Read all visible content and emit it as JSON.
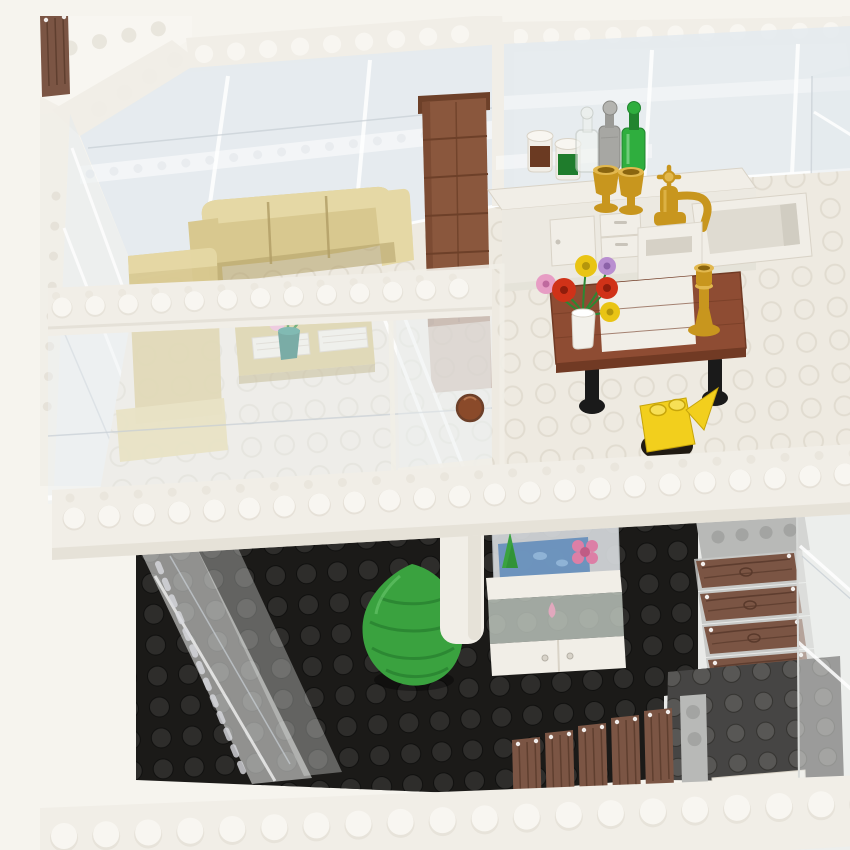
{
  "image": {
    "caption": "Photograph of a two-story LEGO modular house with transparent glass walls viewed from an elevated angle: upper floor with tan sofa and armchair, brown brick chimney, white kitchen counter holding jars, bottles, gold goblets and a gold faucet sink, a brown dining table with a white runner, flower vase, gold candlestick and yellow watering can; ground floor with black studded baseplate, green leaf tree, white column, aquarium cabinet and a wooden staircase."
  },
  "palette": {
    "bg": "#f6f4ee",
    "white_hi": "#f8f6f1",
    "white_plastic": "#f1eee7",
    "white_shade": "#e3dfd5",
    "stud_line": "#d9d3c7",
    "glass": "#e4eaee",
    "glass_line": "#c8cfd5",
    "floor": "#eeeae1",
    "floor_stud": "#ded8cc",
    "black_plate": "#1b1a18",
    "black_stud": "#2e2d2b",
    "dark_gray": "#464544",
    "dark_gray_stud": "#585755",
    "light_gray": "#b8b9b7",
    "light_gray_stud": "#a3a4a2",
    "tan": "#d8c88f",
    "tan_dark": "#b3a068",
    "tan_light": "#e5d8a5",
    "brown": "#8a573d",
    "brown_dark": "#6d4029",
    "table_brown": "#8e4c33",
    "table_dark": "#713a24",
    "wood": "#7b5544",
    "wood_dark": "#59392b",
    "gold": "#c8961e",
    "gold_light": "#e2b84e",
    "bottle_green": "#2fae3e",
    "bottle_green_dark": "#22842f",
    "bottle_grey": "#a7a7a3",
    "jar_brown": "#6b3a22",
    "jar_green": "#1f7c2c",
    "tree_green": "#3aa23f",
    "tree_dark": "#2c8833",
    "flower_red": "#d03218",
    "flower_yellow": "#e9c414",
    "flower_pink": "#e79dc4",
    "flower_lavender": "#b98fd0",
    "flower_purple": "#9b6cc0",
    "flower_white": "#ffffff",
    "vase_teal": "#2e7d72",
    "aqua_blue": "#5d89ba",
    "aqua_pink": "#dc7fa6",
    "door_knob": "#8a4a2a",
    "can_yellow": "#f2cf1d",
    "pot_black": "#201a12"
  },
  "scene": {
    "setting": "Two-story LEGO house with transparent wall panels and white studded plate framing, elevated three-quarter view",
    "upper_floor": {
      "floor": "white studded plates",
      "objects": [
        "tan sofa",
        "tan armchair",
        "tan coffee bench with white grilles",
        "bouquet of white, pink and purple flowers in teal vase",
        "reddish-brown brick chimney column",
        "white kitchen counter with door and drawers",
        "jar with brown contents",
        "jar with green contents",
        "clear bottle",
        "grey bottle",
        "green bottle",
        "two gold goblets",
        "white sink basin with gold faucet",
        "brown dining table with white runner and black legs",
        "vase of red, yellow, pink and lavender flowers",
        "gold candlestick",
        "yellow watering can on black pot",
        "transparent interior door with brown knob",
        "white balcony rail beam"
      ]
    },
    "ground_floor": {
      "floor": "black studded baseplate",
      "objects": [
        "green leaf-shaped tree",
        "white support column",
        "aquarium cabinet with blue water, green plant, fish and pink flower",
        "light gray stair landing plate",
        "four brown wood-grain stair treads",
        "five upright wood planks",
        "light gray plate bar",
        "dark gray studded plate",
        "white tile"
      ]
    },
    "structure": [
      "white studded roof rim beams",
      "transparent glass wall panels",
      "white floor-edge beam between stories",
      "white front rim beam"
    ]
  }
}
